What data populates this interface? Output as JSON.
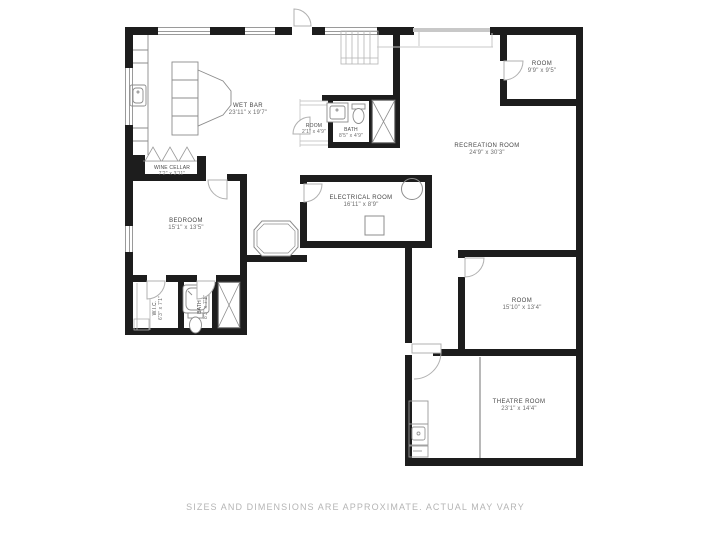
{
  "colors": {
    "wall": "#1d1d1d",
    "fixture_line": "#8c8c8c",
    "door_arc": "#b0b0b0",
    "label_text": "#474747",
    "footer_text": "#b5b5b5"
  },
  "rooms": [
    {
      "id": "wet-bar",
      "name": "WET BAR",
      "dims": "23'11\" x 19'7\""
    },
    {
      "id": "closet-room",
      "name": "ROOM",
      "dims": "2'1\" x 4'9\""
    },
    {
      "id": "bath-upper",
      "name": "BATH",
      "dims": "8'5\" x 4'9\""
    },
    {
      "id": "room-top-right",
      "name": "ROOM",
      "dims": "9'9\" x 9'5\""
    },
    {
      "id": "recreation",
      "name": "RECREATION ROOM",
      "dims": "24'9\" x 30'3\""
    },
    {
      "id": "wine-cellar",
      "name": "WINE CELLAR",
      "dims": "7'2\" x 3'11\""
    },
    {
      "id": "bedroom",
      "name": "BEDROOM",
      "dims": "15'1\" x 13'5\""
    },
    {
      "id": "electrical",
      "name": "ELECTRICAL ROOM",
      "dims": "16'11\" x 8'9\""
    },
    {
      "id": "wic",
      "name": "W.I.C.",
      "dims": "6'3\" x 7'1\""
    },
    {
      "id": "bath-lower",
      "name": "BATH",
      "dims": "8'3\" x 7'1\""
    },
    {
      "id": "room-mid-right",
      "name": "ROOM",
      "dims": "15'10\" x 13'4\""
    },
    {
      "id": "theatre-room",
      "name": "THEATRE ROOM",
      "dims": "23'1\" x 14'4\""
    }
  ],
  "footer": {
    "disclaimer": "SIZES AND DIMENSIONS ARE APPROXIMATE. ACTUAL MAY VARY"
  }
}
